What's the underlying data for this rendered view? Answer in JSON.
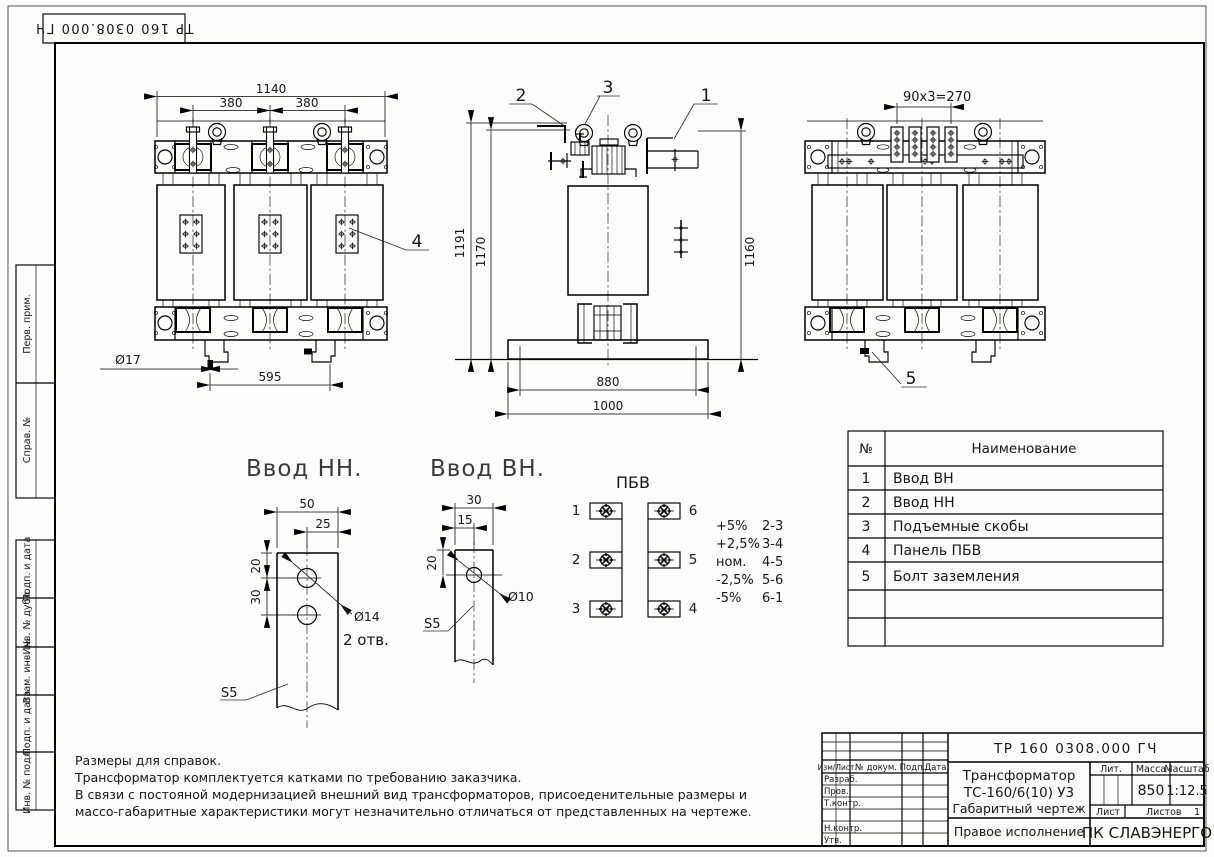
{
  "corner_stamp": {
    "doc_number": "ТР 160 0308.000 ГЧ"
  },
  "margin": {
    "perv": "Перв. прим.",
    "sprav": "Справ. №",
    "podp1": "Подп. и дата",
    "inv_dubl": "Инв. № дубл.",
    "vzam": "Взам. инв. №",
    "podp2": "Подп. и дата",
    "inv_podl": "Инв. № подл."
  },
  "front_view": {
    "dim_width": "1140",
    "dim_span_left": "380",
    "dim_span_right": "380",
    "dim_hole": "Ø17",
    "dim_feet": "595",
    "callout_panel": "4"
  },
  "side_view": {
    "callout_hv": "1",
    "callout_lv": "2",
    "callout_lug": "3",
    "dim_h1": "1191",
    "dim_h2": "1170",
    "dim_h3": "1160",
    "dim_base_inner": "880",
    "dim_base": "1000"
  },
  "rear_view": {
    "dim_taps": "90x3=270",
    "callout_bolt": "5"
  },
  "lv_detail": {
    "title": "Ввод НН.",
    "dim_w": "50",
    "dim_half": "25",
    "dim_v1": "20",
    "dim_v2": "30",
    "dim_dia": "Ø14",
    "holes_note": "2 отв.",
    "thickness": "S5"
  },
  "hv_detail": {
    "title": "Ввод ВН.",
    "dim_w": "30",
    "dim_half": "15",
    "dim_v1": "20",
    "dim_dia": "Ø10",
    "thickness": "S5"
  },
  "pbv": {
    "title": "ПБВ",
    "terminals": [
      "1",
      "2",
      "3",
      "4",
      "5",
      "6"
    ],
    "taps": [
      {
        "label": "+5%",
        "pins": "2-3"
      },
      {
        "label": "+2,5%",
        "pins": "3-4"
      },
      {
        "label": "ном.",
        "pins": "4-5"
      },
      {
        "label": "-2,5%",
        "pins": "5-6"
      },
      {
        "label": "-5%",
        "pins": "6-1"
      }
    ]
  },
  "parts_table": {
    "col_no": "№",
    "col_name": "Наименование",
    "rows": [
      {
        "no": "1",
        "name": "Ввод ВН"
      },
      {
        "no": "2",
        "name": "Ввод НН"
      },
      {
        "no": "3",
        "name": "Подъемные скобы"
      },
      {
        "no": "4",
        "name": "Панель ПБВ"
      },
      {
        "no": "5",
        "name": "Болт заземления"
      }
    ]
  },
  "notes": {
    "line1": "Размеры для справок.",
    "line2": "Трансформатор комплектуется катками по требованию заказчика.",
    "line3": "В связи с постояной модернизацией внешний вид трансформаторов, присоеденительные размеры и",
    "line4": "массо-габаритные характеристики могут незначительно отличаться от представленных на чертеже."
  },
  "title_block": {
    "doc_number": "ТР 160 0308.000 ГЧ",
    "product_name_1": "Трансформатор",
    "product_name_2": "ТС-160/6(10) У3",
    "doc_type": "Габаритный чертеж",
    "variant": "Правое исполнение",
    "company": "ПК СЛАВЭНЕРГО",
    "col_izm": "Изм/Лист",
    "col_doc": "№ докум.",
    "col_sign": "Подп.",
    "col_date": "Дата",
    "row_razrab": "Разраб.",
    "row_prov": "Пров.",
    "row_tcontr": "Т.контр.",
    "row_ncontr": "Н.контр.",
    "row_utv": "Утв.",
    "lit_label": "Лит.",
    "mass_label": "Масса",
    "scale_label": "Масштаб",
    "mass_value": "850",
    "scale_value": "1:12.5",
    "sheet_label": "Лист",
    "sheets_label": "Листов",
    "sheets_value": "1"
  }
}
